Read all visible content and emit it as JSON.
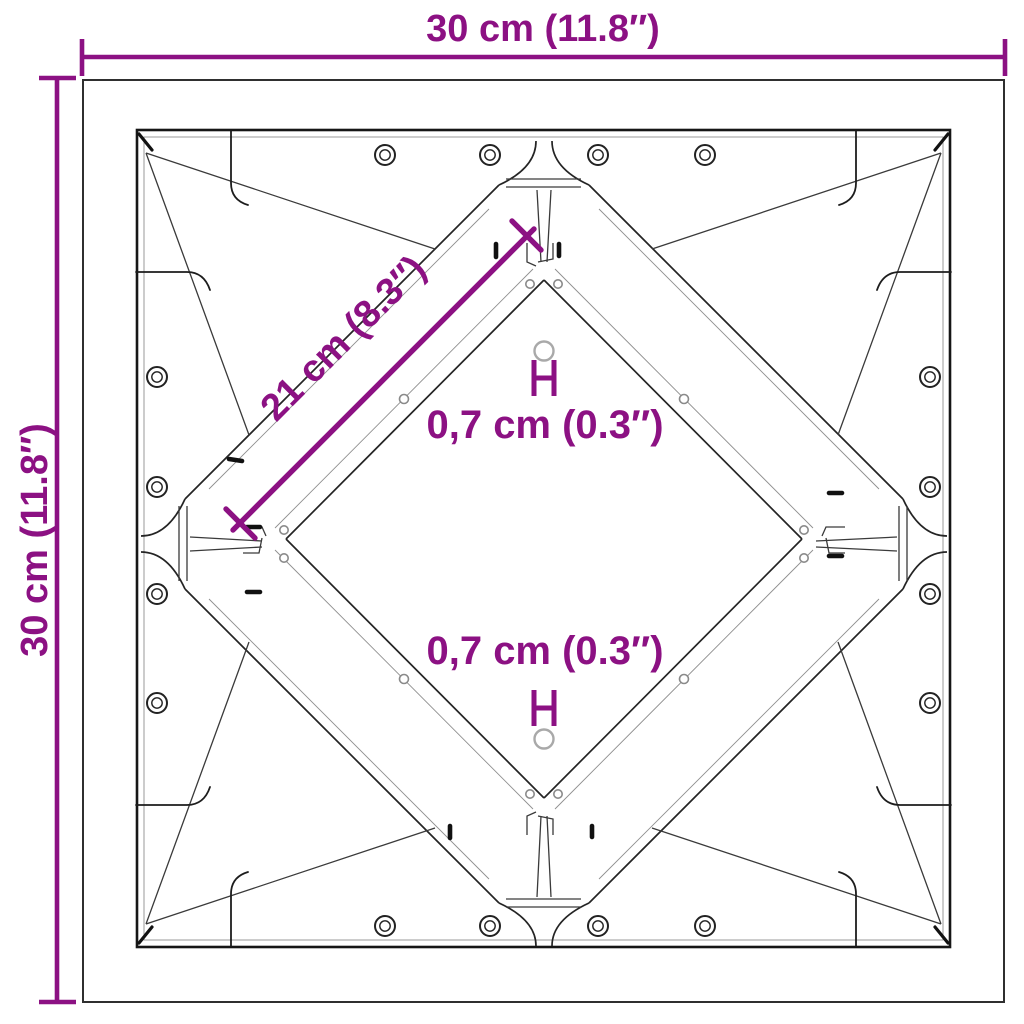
{
  "colors": {
    "accent_purple": "#8C1183",
    "line_dark": "#1a1a1a",
    "line_light": "#8f8f8f",
    "background": "#ffffff"
  },
  "dimensions": {
    "width_top": "30 cm (11.8″)",
    "height_left": "30 cm (11.8″)",
    "brace_diagonal": "21 cm (8.3″)",
    "hole_upper": "0,7 cm (0.3″)",
    "hole_lower": "0,7 cm (0.3″)"
  }
}
